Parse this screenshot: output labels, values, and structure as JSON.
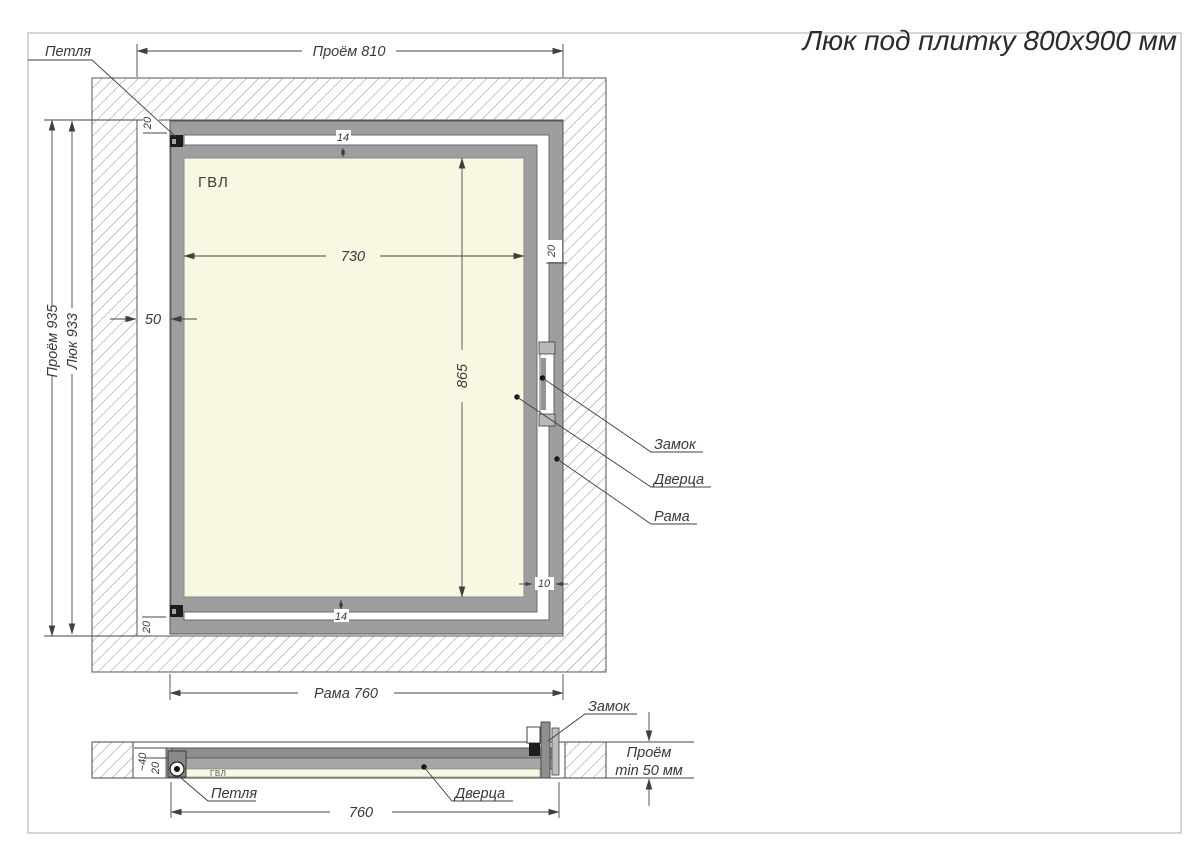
{
  "title": "Люк под плитку 800х900 мм",
  "front": {
    "dim_opening_width": "Проём 810",
    "dim_opening_height": "Проём 935",
    "dim_hatch_height": "Люк 933",
    "dim_frame_width": "Рама 760",
    "dim_panel_width": "730",
    "dim_panel_height": "865",
    "dim_side_gap": "50",
    "dim_gap_top": "14",
    "dim_gap_bottom": "14",
    "dim_hinge_top": "20",
    "dim_hinge_bottom": "20",
    "dim_frame_profile": "20",
    "dim_lock_gap": "10",
    "label_hinge": "Петля",
    "label_lock": "Замок",
    "label_door": "Дверца",
    "label_frame": "Рама",
    "label_panel": "ГВЛ"
  },
  "section": {
    "dim_frame_width": "760",
    "dim_depth_total": "~40",
    "dim_depth_panel": "20",
    "dim_opening_depth_line1": "Проём",
    "dim_opening_depth_line2": "min 50 мм",
    "label_hinge": "Петля",
    "label_lock": "Замок",
    "label_door": "Дверца",
    "label_panel": "ГВЛ"
  },
  "colors": {
    "frame_gray": "#9e9e9e",
    "panel_cream": "#f8f7e2",
    "hatch_line": "#8f8f8f",
    "text": "#3a3a3a"
  }
}
